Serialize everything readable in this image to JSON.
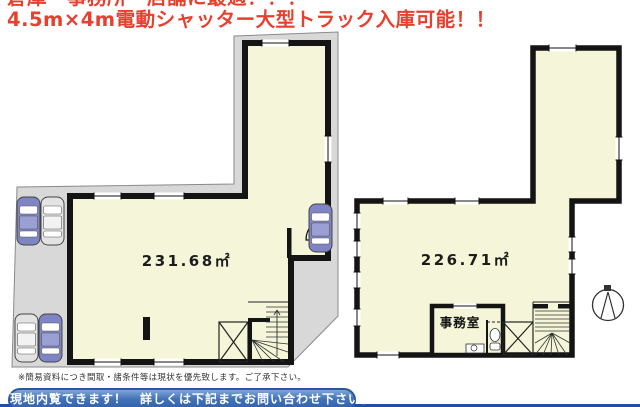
{
  "header": {
    "line1": "倉庫・事務所・店舗に最適！！！",
    "line2": "4.5m×4m電動シャッター大型トラック入庫可能！！"
  },
  "plans": {
    "left": {
      "area": "231.68㎡"
    },
    "right": {
      "area": "226.71㎡",
      "office": "事務室"
    }
  },
  "footer": {
    "disclaimer": "※簡易資料につき間取・諸条件等は現状を優先致します。ご了承下さい。",
    "banner": "現地内覧できます！　詳しくは下記までお問い合わせ下さい。"
  },
  "colors": {
    "accent_red": "#e8402f",
    "banner_blue": "#3a6ab1",
    "floor_fill": "#f5f6d9",
    "site_gray": "#d8d8d8",
    "car_blue": "#7f85c4"
  }
}
